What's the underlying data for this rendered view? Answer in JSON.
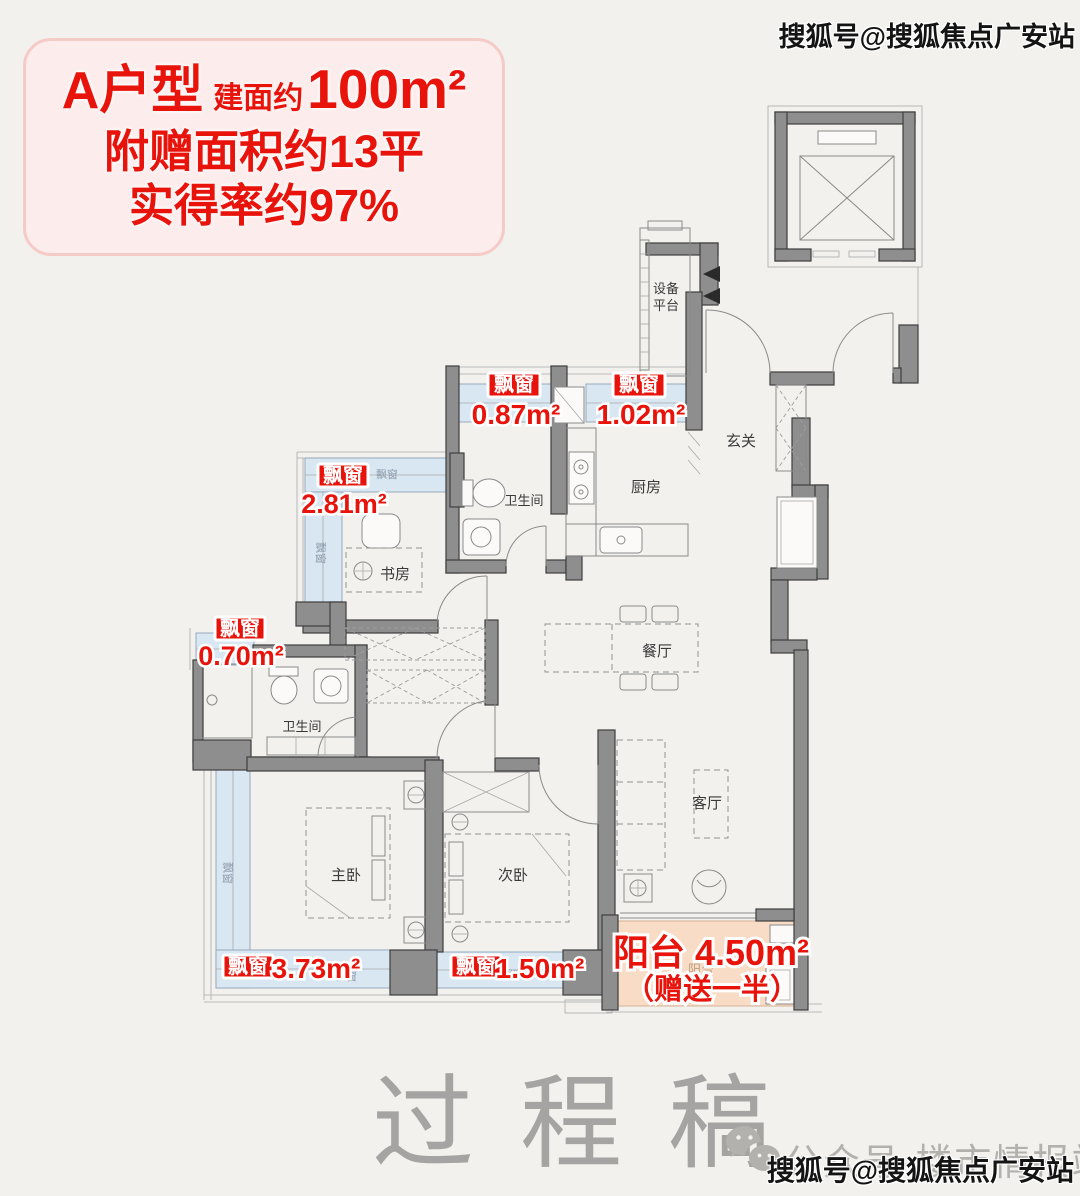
{
  "header": {
    "unit": "A户型",
    "area_prefix": "建面约",
    "area_value": "100m²",
    "line2": "附赠面积约13平",
    "line3": "实得率约97%"
  },
  "watermarks": {
    "sohu_top": "搜狐号@搜狐焦点广安站",
    "sohu_bottom": "搜狐号@搜狐焦点广安站",
    "wechat_account": "公众号·楼市情报站",
    "draft": "过程稿"
  },
  "rooms": {
    "entry": "玄关",
    "kitchen": "厨房",
    "bathroom": "卫生间",
    "bathroom2": "卫生间",
    "dining": "餐厅",
    "living": "客厅",
    "study": "书房",
    "master_bedroom": "主卧",
    "second_bedroom": "次卧",
    "equipment_platform_line1": "设备",
    "equipment_platform_line2": "平台",
    "bay_window_small": "飘窗",
    "balcony_faint": "阳台"
  },
  "annotations": {
    "bay_window_label": "飘窗",
    "bay_windows": [
      {
        "area": "0.87m²"
      },
      {
        "area": "1.02m²"
      },
      {
        "area": "2.81m²"
      },
      {
        "area": "0.70m²"
      },
      {
        "area": "3.73m²"
      },
      {
        "area": "1.50m²"
      }
    ],
    "balcony_title": "阳台 4.50m²",
    "balcony_note": "（赠送一半）"
  },
  "colors": {
    "wall": "#8e8e8e",
    "bay": "#d9e7f3",
    "balcony": "#f8dcc5",
    "red": "#e8140c",
    "header_bg": "#fdecec",
    "header_border": "#f5cbc8",
    "bg": "#f2f1ee"
  }
}
